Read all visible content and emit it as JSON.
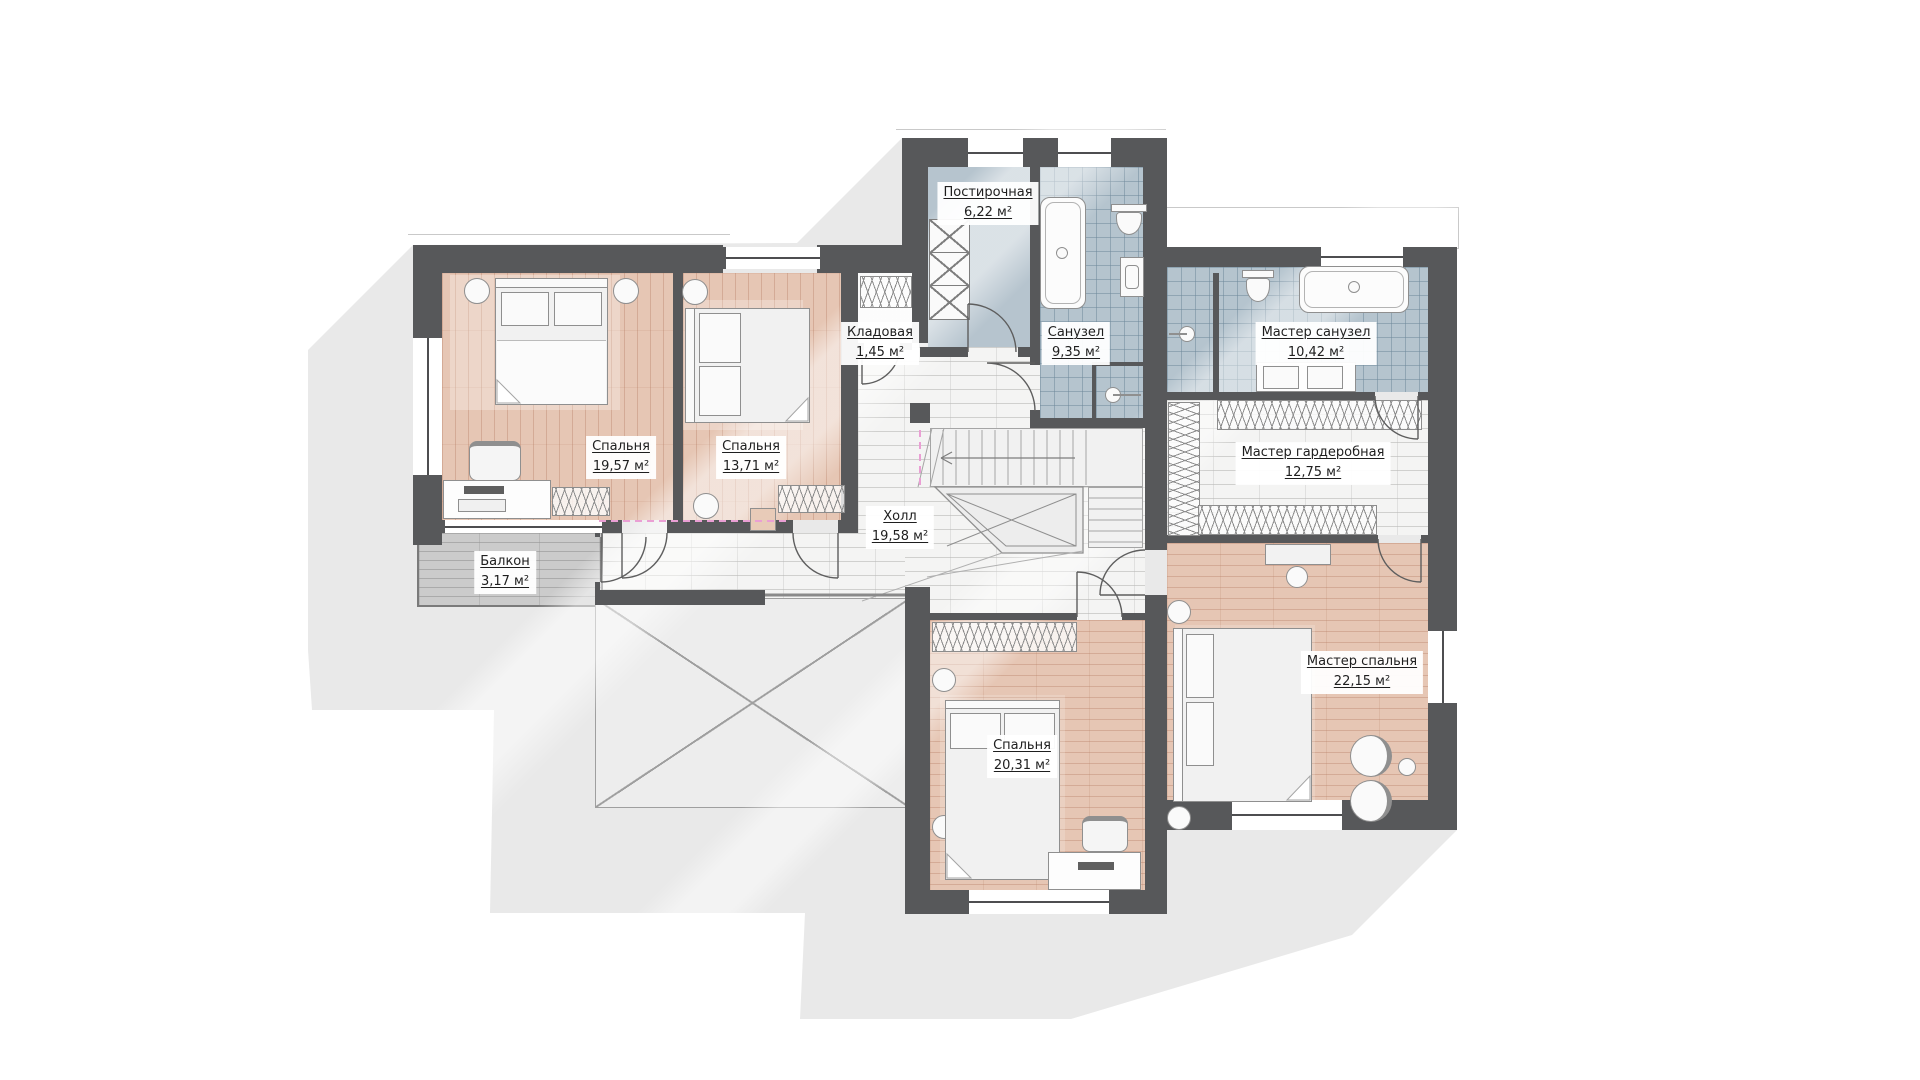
{
  "plan": {
    "type": "floor-plan",
    "language": "ru",
    "area_unit": "м²",
    "rooms": [
      {
        "id": "laundry",
        "name": "Постирочная",
        "area": "6,22 м²"
      },
      {
        "id": "storage",
        "name": "Кладовая",
        "area": "1,45 м²"
      },
      {
        "id": "bathroom",
        "name": "Санузел",
        "area": "9,35 м²"
      },
      {
        "id": "master-bathroom",
        "name": "Мастер санузел",
        "area": "10,42 м²"
      },
      {
        "id": "bedroom-1",
        "name": "Спальня",
        "area": "19,57 м²"
      },
      {
        "id": "bedroom-2",
        "name": "Спальня",
        "area": "13,71 м²"
      },
      {
        "id": "hall",
        "name": "Холл",
        "area": "19,58 м²"
      },
      {
        "id": "master-wardrobe",
        "name": "Мастер гардеробная",
        "area": "12,75 м²"
      },
      {
        "id": "balcony",
        "name": "Балкон",
        "area": "3,17 м²"
      },
      {
        "id": "bedroom-3",
        "name": "Спальня",
        "area": "20,31 м²"
      },
      {
        "id": "master-bedroom",
        "name": "Мастер спальня",
        "area": "22,15 м²"
      }
    ],
    "colors": {
      "wall": "#57585a",
      "bedroom_floor": "#e6c6b4",
      "wet_room_tile": "#b5c4ce",
      "hall_tile": "#f4f4f3",
      "balcony_floor": "#cbcbcb",
      "shadow": "#e9e9e9",
      "opening_dashed_line": "#ea9fd4"
    }
  }
}
